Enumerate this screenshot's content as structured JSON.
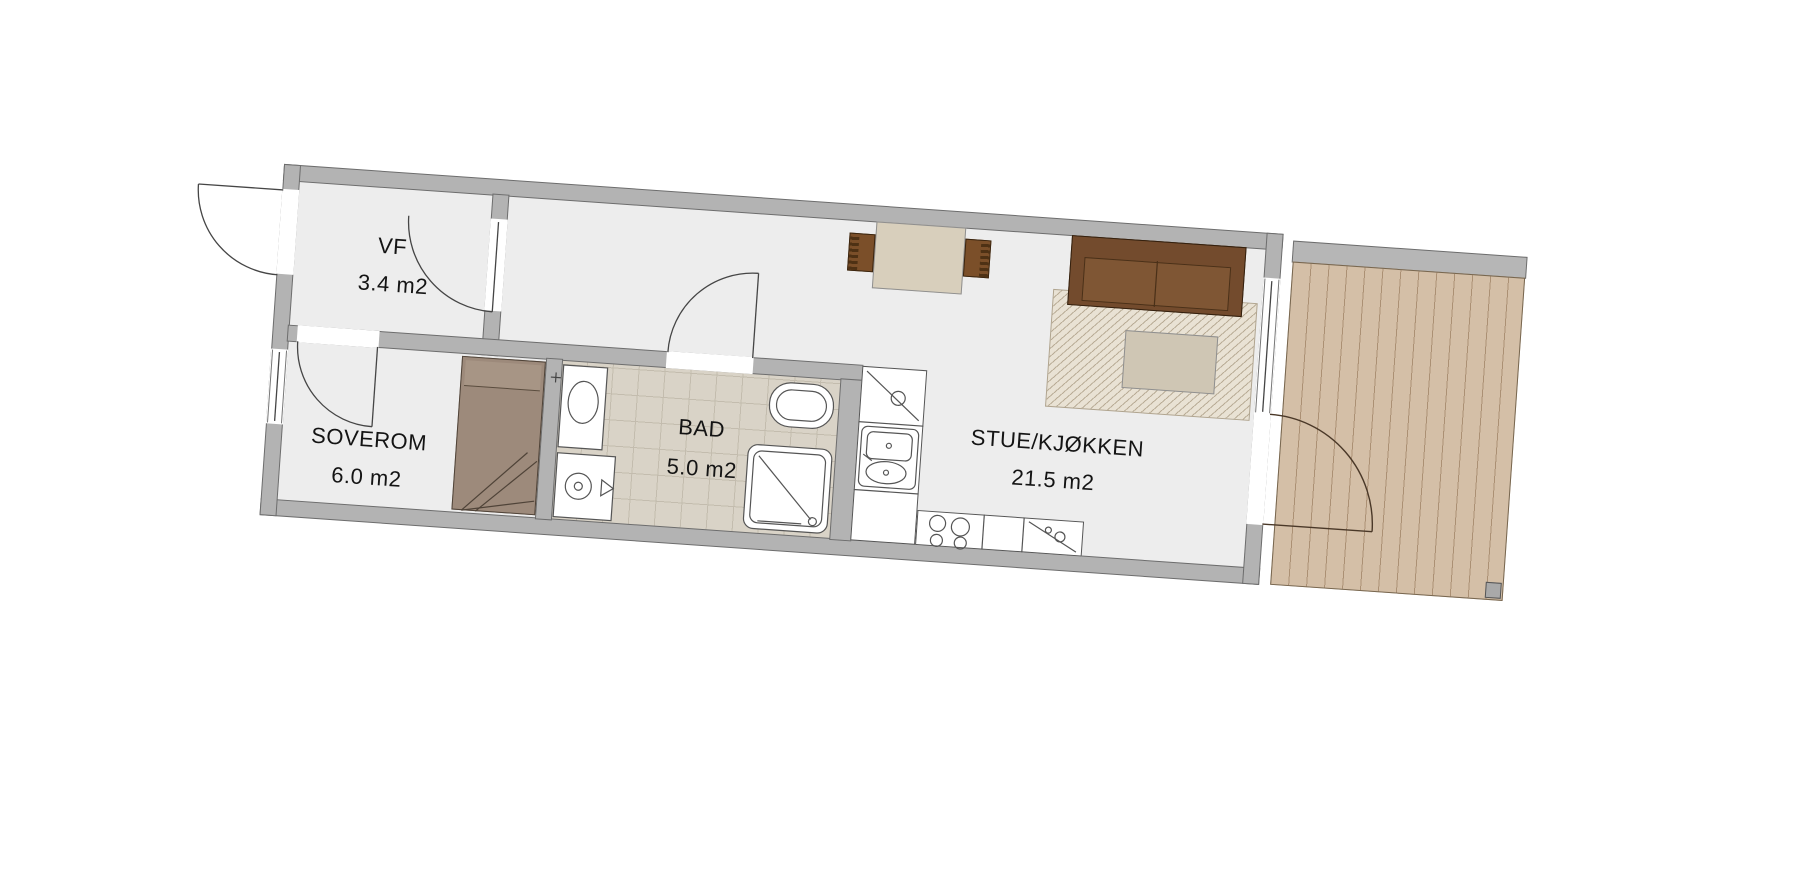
{
  "rooms": [
    {
      "id": "vf",
      "label": "VF",
      "area": "3.4 m2"
    },
    {
      "id": "soverom",
      "label": "SOVEROM",
      "area": "6.0 m2"
    },
    {
      "id": "bad",
      "label": "BAD",
      "area": "5.0 m2"
    },
    {
      "id": "stue-kjokken",
      "label": "STUE/KJØKKEN",
      "area": "21.5 m2"
    }
  ],
  "fixtures": [
    "entrance-door-swing",
    "vf-interior-door-swing",
    "soverom-door-swing",
    "bad-door-swing",
    "terrace-door-swing",
    "bed",
    "bathroom-sink",
    "washing-machine",
    "toilet",
    "shower",
    "kitchen-cabinet",
    "kitchen-sink",
    "cooktop",
    "counter-appliance",
    "dining-table",
    "chair-left",
    "chair-right",
    "sofa",
    "rug",
    "coffee-table",
    "terrace-deck",
    "terrace-post",
    "window-left",
    "window-right"
  ],
  "colors": {
    "wall": "#b3b3b3",
    "wall_outline": "#6d6d6d",
    "floor": "#ededed",
    "bath_tile": "#d9d3c7",
    "deck": "#d4bfa7",
    "deck_line": "#ab9074",
    "sofa_back": "#734b2d",
    "sofa_seat": "#7f5634",
    "bed": "#9d8a7b",
    "dining_table": "#d8cfbc",
    "chair": "#7b4f29",
    "rug_base": "#e9e2d4",
    "rug_line": "#b9ac96",
    "coffee_table": "#cfc6b4",
    "text": "#141414"
  }
}
